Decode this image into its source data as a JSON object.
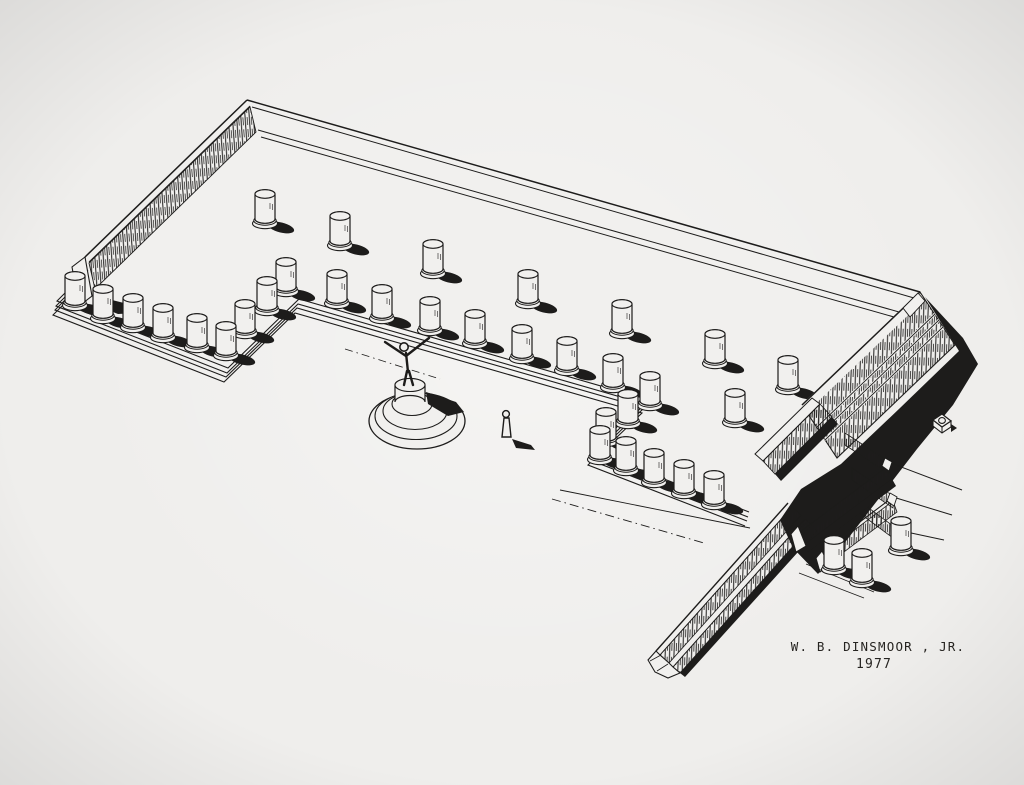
{
  "artwork": {
    "signature": "W. B. DINSMOOR , JR.",
    "year": "1977",
    "ink_color": "#1d1c1b",
    "paper_color": "#efeeec"
  },
  "drawing": {
    "features": [
      "u-shaped stoa platform in axonometric view",
      "hatched rubble walls",
      "stepped krepis edge lines",
      "column stubs with cast shadows",
      "statue with outstretched arms on round stepped base",
      "standing human scale figure",
      "small well block with circular opening",
      "long narrow ramp wall running southwest",
      "annex stepped wall corner with broken trace lines",
      "solid black ground shadow along southeast podium face"
    ],
    "columns": {
      "main": [
        [
          265,
          226
        ],
        [
          340,
          248
        ],
        [
          433,
          276
        ],
        [
          528,
          306
        ],
        [
          622,
          336
        ],
        [
          715,
          366
        ],
        [
          788,
          392
        ],
        [
          75,
          308
        ],
        [
          103,
          321
        ],
        [
          133,
          330
        ],
        [
          163,
          340
        ],
        [
          197,
          350
        ],
        [
          226,
          358
        ],
        [
          245,
          336
        ],
        [
          267,
          313
        ],
        [
          286,
          294
        ],
        [
          337,
          306
        ],
        [
          382,
          321
        ],
        [
          430,
          333
        ],
        [
          475,
          346
        ],
        [
          522,
          361
        ],
        [
          567,
          373
        ],
        [
          613,
          390
        ],
        [
          650,
          408
        ],
        [
          628,
          426
        ],
        [
          606,
          444
        ],
        [
          600,
          462
        ],
        [
          626,
          473
        ],
        [
          654,
          485
        ],
        [
          684,
          496
        ],
        [
          714,
          507
        ],
        [
          735,
          425
        ]
      ],
      "annex": [
        [
          834,
          572
        ],
        [
          862,
          585
        ],
        [
          901,
          553
        ]
      ]
    },
    "statue": {
      "x": 412,
      "y": 414
    },
    "scale_figure": {
      "x": 507,
      "y": 437
    },
    "well_block": {
      "x": 942,
      "y": 424
    }
  }
}
